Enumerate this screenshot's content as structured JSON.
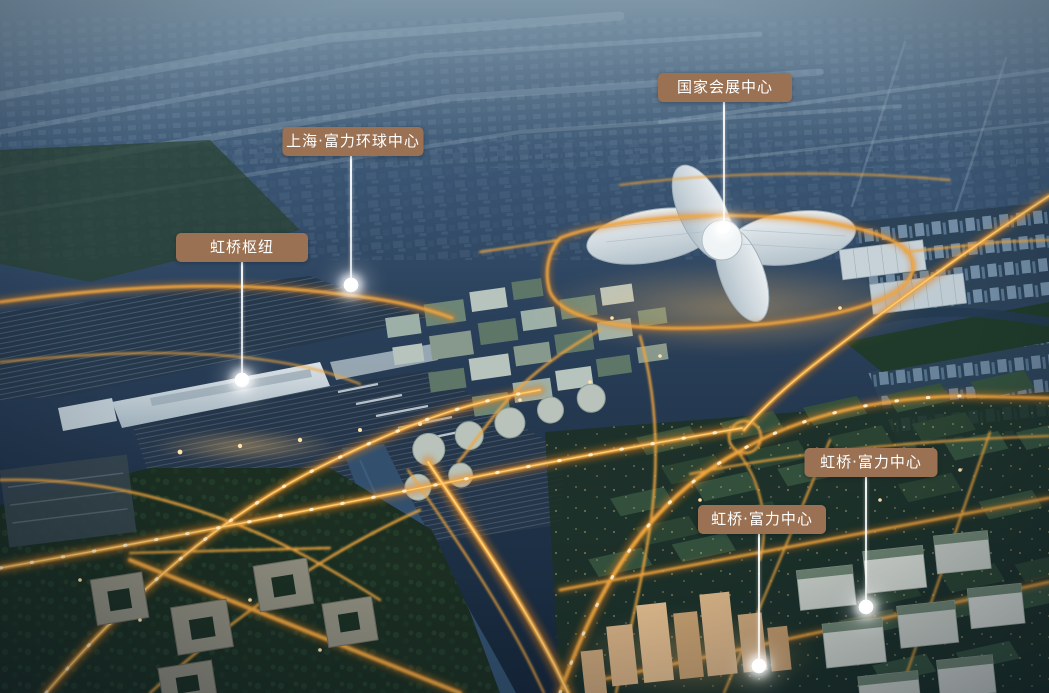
{
  "canvas": {
    "width": 1049,
    "height": 693
  },
  "palette": {
    "label_background": "#9a7253",
    "label_text": "#ffffff",
    "leader_line": "#ffffff",
    "marker_dot": "#ffffff",
    "road_core": "#ffc967",
    "road_glow": "#e08a20",
    "sky_haze": "#64798b",
    "night_city": "#22364a",
    "river": "#32506d",
    "green_roof": "#33503d",
    "light_roof": "#ccd6db"
  },
  "markers": [
    {
      "id": "national-exhibition-center",
      "label": "国家会展中心",
      "label_cx": 725,
      "label_top": 73,
      "label_w": 134,
      "dot_x": 724,
      "dot_y": 228
    },
    {
      "id": "shanghai-rf-global-center",
      "label": "上海·富力环球中心",
      "label_cx": 353,
      "label_top": 127,
      "label_w": 141,
      "dot_x": 351,
      "dot_y": 285
    },
    {
      "id": "hongqiao-hub",
      "label": "虹桥枢纽",
      "label_cx": 242,
      "label_top": 233,
      "label_w": 132,
      "dot_x": 242,
      "dot_y": 380
    },
    {
      "id": "hongqiao-rf-center-east",
      "label": "虹桥·富力中心",
      "label_cx": 871,
      "label_top": 448,
      "label_w": 133,
      "dot_x": 866,
      "dot_y": 607
    },
    {
      "id": "hongqiao-rf-center-south",
      "label": "虹桥·富力中心",
      "label_cx": 762,
      "label_top": 505,
      "label_w": 128,
      "dot_x": 759,
      "dot_y": 666
    }
  ]
}
